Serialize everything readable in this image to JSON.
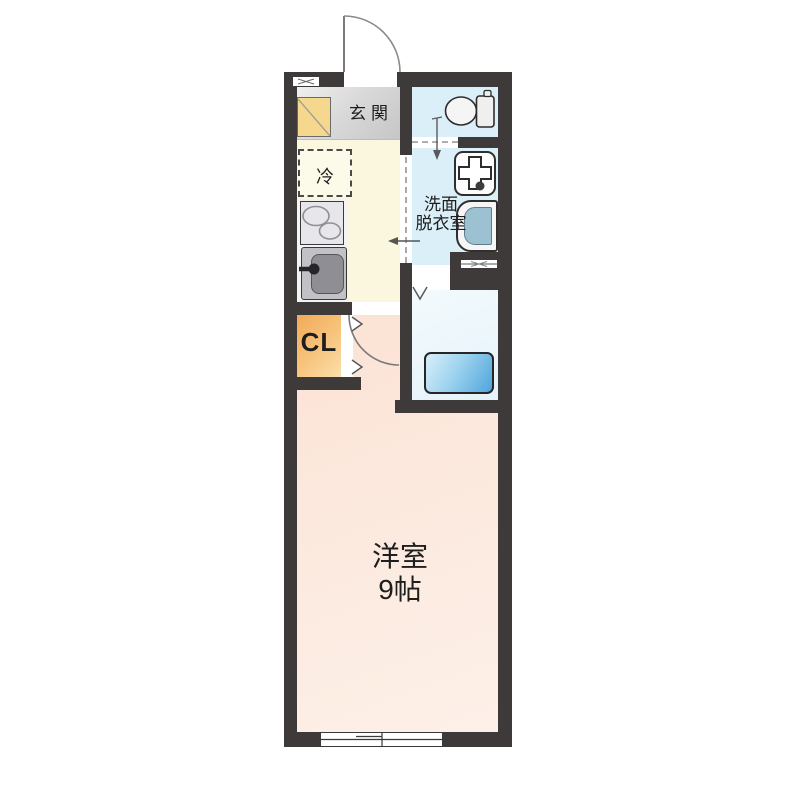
{
  "plan": {
    "title": "1K apartment floor plan",
    "labels": {
      "genkan": "玄関",
      "fridge": "冷",
      "washroom_line1": "洗面",
      "washroom_line2": "脱衣室",
      "closet": "CL",
      "room_line1": "洋室",
      "room_line2": "9帖"
    },
    "icons": {
      "entrance": "door-swing-icon",
      "toilet": "toilet-icon",
      "washing_machine": "washing-machine-pan-icon",
      "washbasin": "washbasin-icon",
      "bathtub": "bathtub-icon",
      "stove": "stove-burners-icon",
      "sink": "kitchen-sink-icon",
      "closet_door": "folding-door-chevrons-icon",
      "bath_door": "folding-door-v-icon",
      "windows": "sliding-window-icon"
    },
    "colors": {
      "wall": "#3E3A3A",
      "genkan": "#DADADA",
      "kitchen": "#FAF7DE",
      "shoe_cabinet": "#F5D78E",
      "closet": "#F2A957",
      "toilet_floor": "#DBEFF8",
      "washroom_floor": "#DBEFF8",
      "bathroom_floor": "#EDF6FB",
      "bathtub": "#4FA5DB",
      "main_room": "#FBE2D4",
      "outline": "#3E3A3A"
    }
  }
}
